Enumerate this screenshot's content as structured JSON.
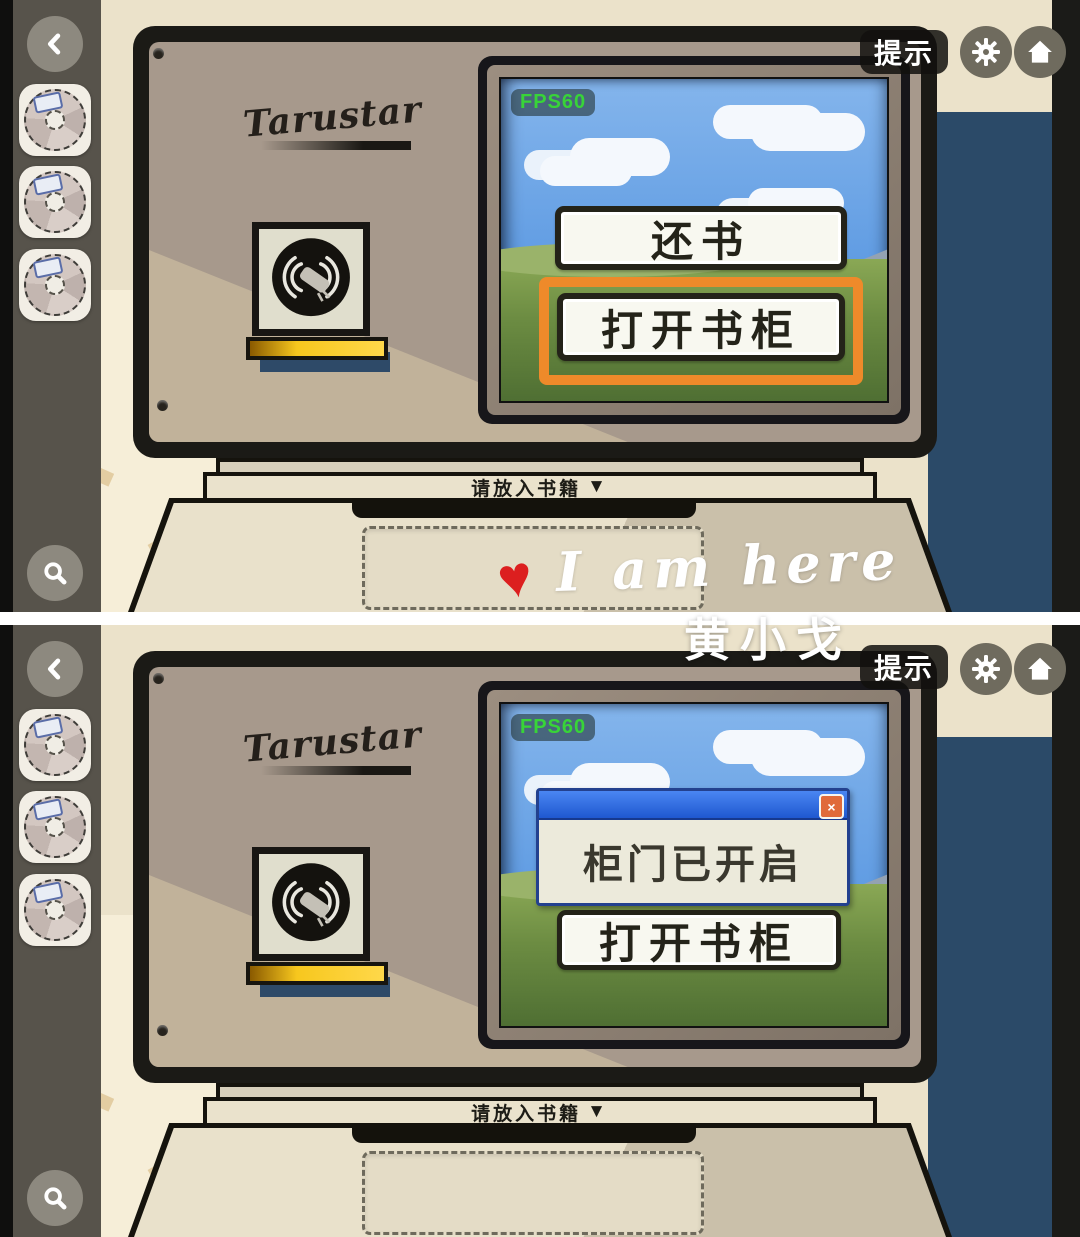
{
  "topbar": {
    "hint_label": "提示",
    "gear_icon": "gear",
    "home_icon": "home"
  },
  "sidebar": {
    "back_icon": "chevron-left",
    "zoom_icon": "magnifier",
    "slot_item_icon": "cd-disc",
    "slot_count": 3
  },
  "brand": {
    "name": "Tarustar"
  },
  "screen": {
    "fps_label": "FPS60"
  },
  "panel1": {
    "return_button_label": "还书",
    "open_button_label": "打开书柜",
    "highlight_color": "#ee8a2a"
  },
  "panel2": {
    "dialog_message": "柜门已开启",
    "dialog_close_label": "×",
    "open_button_label": "打开书柜"
  },
  "base": {
    "insert_label": "请放入书籍",
    "insert_arrow": "▼"
  },
  "watermark": {
    "heart": "♥",
    "text": "I am here",
    "signature": "黄小戈"
  },
  "colors": {
    "highlight_orange": "#ee8a2a",
    "wall_blue": "#2b4a68",
    "dialog_blue": "#2a62d8",
    "fps_green": "#38d438",
    "sidebar_olive": "#57534b"
  }
}
